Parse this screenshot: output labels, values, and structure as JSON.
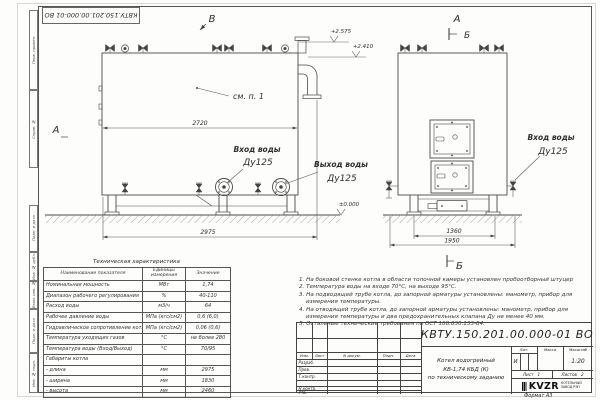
{
  "stamp": {
    "doc_number_top": "КВТУ.150.201.00.000-01 ВО"
  },
  "margin_labels": [
    "Перв. примен.",
    "Справ. №",
    "Подп. и дата",
    "Инв. № дубл.",
    "Взам. инв. №",
    "Подп. и дата",
    "Инв. № подл."
  ],
  "drawing": {
    "view_b": "В",
    "view_a_side": "А",
    "view_a_front": "А",
    "section_b_top": "Б",
    "section_b_bottom": "Б",
    "see_note": "см. п. 1",
    "elev_top": "+2.575",
    "elev_flue": "+2.410",
    "elev_zero": "±0.000",
    "dim_width_top": "2720",
    "dim_length": "2975",
    "dim_front_inner": "1360",
    "dim_front_outer": "1950",
    "inlet_title": "Вход воды",
    "inlet_dn": "Ду125",
    "outlet_title": "Выход воды",
    "outlet_dn": "Ду125",
    "inlet2_title": "Вход воды",
    "inlet2_dn": "Ду125"
  },
  "spec": {
    "title": "Техническая характеристика",
    "headers": [
      "Наименование показателя",
      "Единицы измерения",
      "Значение"
    ],
    "rows": [
      [
        "Номинальная мощность",
        "МВт",
        "1,74"
      ],
      [
        "Диапазон рабочего регулирования",
        "%",
        "40-110"
      ],
      [
        "Расход воды",
        "м3/ч",
        "64"
      ],
      [
        "Рабочее давление воды",
        "МПа (кгс/см2)",
        "0,6 (6,0)"
      ],
      [
        "Гидравлическое сопротивление котла",
        "МПа (кгс/см2)",
        "0,06 (0,6)"
      ],
      [
        "Температура уходящих газов",
        "°С",
        "не более 280"
      ],
      [
        "Температура воды (Вход/Выход)",
        "°С",
        "70/95"
      ],
      [
        "Габариты котла",
        "",
        ""
      ],
      [
        "- длина",
        "мм",
        "2975"
      ],
      [
        "- ширина",
        "мм",
        "1830"
      ],
      [
        "- высота",
        "мм",
        "2460"
      ]
    ]
  },
  "notes": [
    "1.  На боковой стенке котла в области топочной камеры установлен пробоотборный штуцер",
    "2.  Температура воды на входе 70°С, на выходе 95°С.",
    "3.  На подводящей трубе котла, до запорной арматуры установлены: манометр, прибор для измерения температуры.",
    "4.  На отводящей трубе котла, до запорной арматуры установлены: манометр, прибор для измерения температуры и два предохранительных клапана Ду не менее 40 мм.",
    "5.  Остальные технические требования по ОСТ 108.030.133-84."
  ],
  "titleblock": {
    "doc_number": "КВТУ.150.201.00.000-01  ВО",
    "change_cols": [
      "Изм.",
      "Лист",
      "N докум.",
      "Подп.",
      "Дата"
    ],
    "roles": [
      "Разраб.",
      "Пров.",
      "Т.контр.",
      "Н.контр.",
      "Утв."
    ],
    "product_line1": "Котел водогрейный",
    "product_line2": "КВ-1,74 КБД (К)",
    "product_line3": "по техническому заданию",
    "lit_header": "Лит.",
    "mass_header": "Масса",
    "scale_header": "Масштаб",
    "lit": "И",
    "scale": "1:20",
    "sheet_label": "Лист",
    "sheet_num": "1",
    "sheets_label": "Листов",
    "sheets_num": "2",
    "logo_text": "KVZR",
    "logo_sub1": "КОТЕЛЬНЫЙ",
    "logo_sub2": "ЗАВОД РЭП",
    "format_label": "Формат  А3"
  },
  "colors": {
    "line": "#444444",
    "text": "#2e2e2e",
    "paper": "#fdfdfc"
  }
}
